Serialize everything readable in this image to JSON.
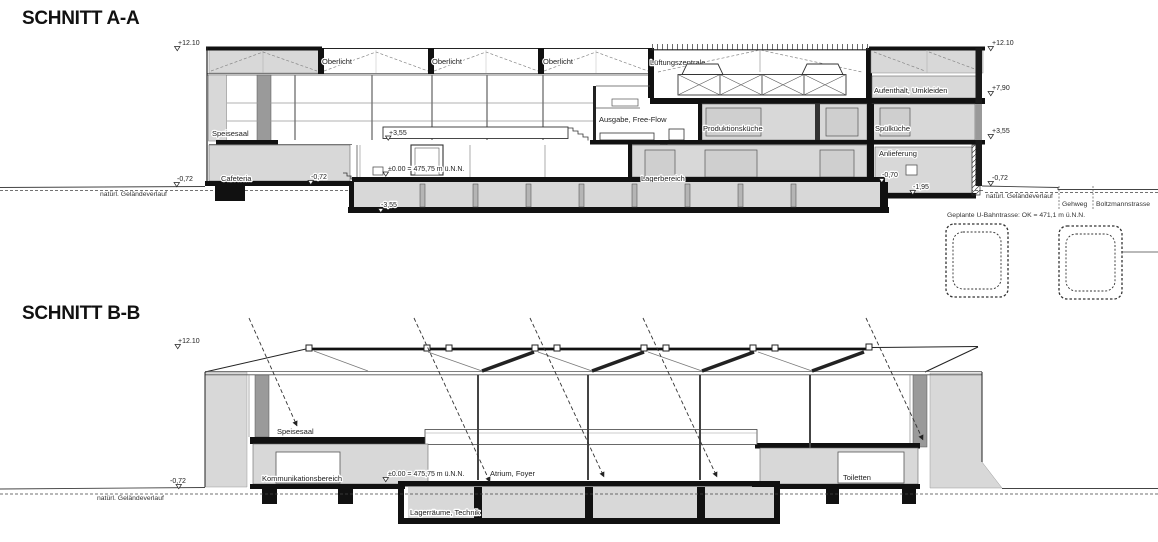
{
  "section_a": {
    "title": "SCHNITT A-A",
    "levels": {
      "top": "+12.10",
      "l790": "+7,90",
      "l355": "+3,55",
      "minus072": "-0,72",
      "zero": "±0.00 = 475,75 m ü.N.N.",
      "minus070": "-0,70",
      "minus195": "-1,95",
      "minus355": "-3,55"
    },
    "rooms": {
      "oberlicht": "Oberlicht",
      "lueftungszentrale": "Lüftungszentrale",
      "aufenthalt": "Aufenthalt, Umkleiden",
      "speisesaal": "Speisesaal",
      "ausgabe": "Ausgabe, Free-Flow",
      "produktionskueche": "Produktionsküche",
      "spuelkueche": "Spülküche",
      "cafeteria": "Cafeteria",
      "lagerbereich": "Lagerbereich",
      "anlieferung": "Anlieferung"
    },
    "site": {
      "gelaende": "natürl. Geländeverlauf",
      "gehweg": "Gehweg",
      "strasse": "Boltzmannstrasse",
      "ubahn": "Geplante U-Bahntrasse: OK = 471,1 m ü.N.N."
    }
  },
  "section_b": {
    "title": "SCHNITT B-B",
    "levels": {
      "top": "+12.10",
      "minus072": "-0,72",
      "zero": "±0.00 = 475,75 m ü.N.N."
    },
    "rooms": {
      "speisesaal": "Speisesaal",
      "kommunikationsbereich": "Kommunikationsbereich",
      "atrium": "Atrium, Foyer",
      "toiletten": "Toiletten",
      "lagerraeume": "Lagerräume, Technik"
    },
    "site": {
      "gelaende": "natürl. Geländeverlauf"
    }
  }
}
